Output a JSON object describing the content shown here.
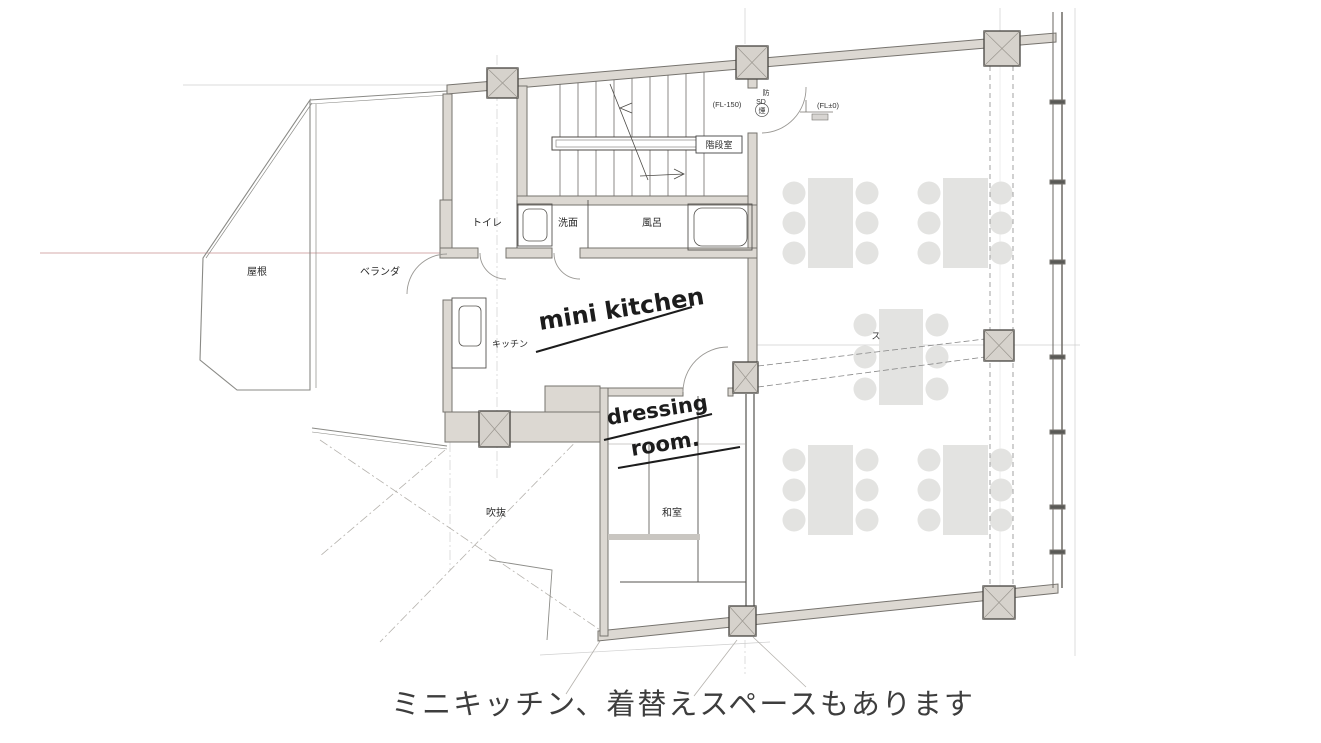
{
  "rooms": {
    "roof": "屋根",
    "veranda": "ベランダ",
    "toilet": "トイレ",
    "washroom": "洗面",
    "bath": "風呂",
    "kitchen": "キッチン",
    "stairwell": "階段室",
    "japanese_room": "和室",
    "atrium": "吹抜",
    "screen": "ス"
  },
  "annotations": {
    "mini_kitchen": "mini kitchen",
    "dressing_line1": "dressing",
    "dressing_line2": "room.",
    "fl_minus_150": "(FL-150)",
    "fl_zero": "(FL±0)",
    "smoke_top": "防",
    "smoke_mid": "SD",
    "smoke_bottom": "煙"
  },
  "caption": {
    "text": "ミニキッチン、着替えスペースもあります"
  },
  "colors": {
    "wall_fill": "#dcd8d2",
    "wall_line": "#76736e",
    "column_line": "#45433f",
    "furniture_gray": "#e3e3e1",
    "grid_gray": "#cfcfcf",
    "reference_red": "#c98f8f",
    "ink": "#2b2b2b",
    "caption_color": "#3d3d3d"
  }
}
